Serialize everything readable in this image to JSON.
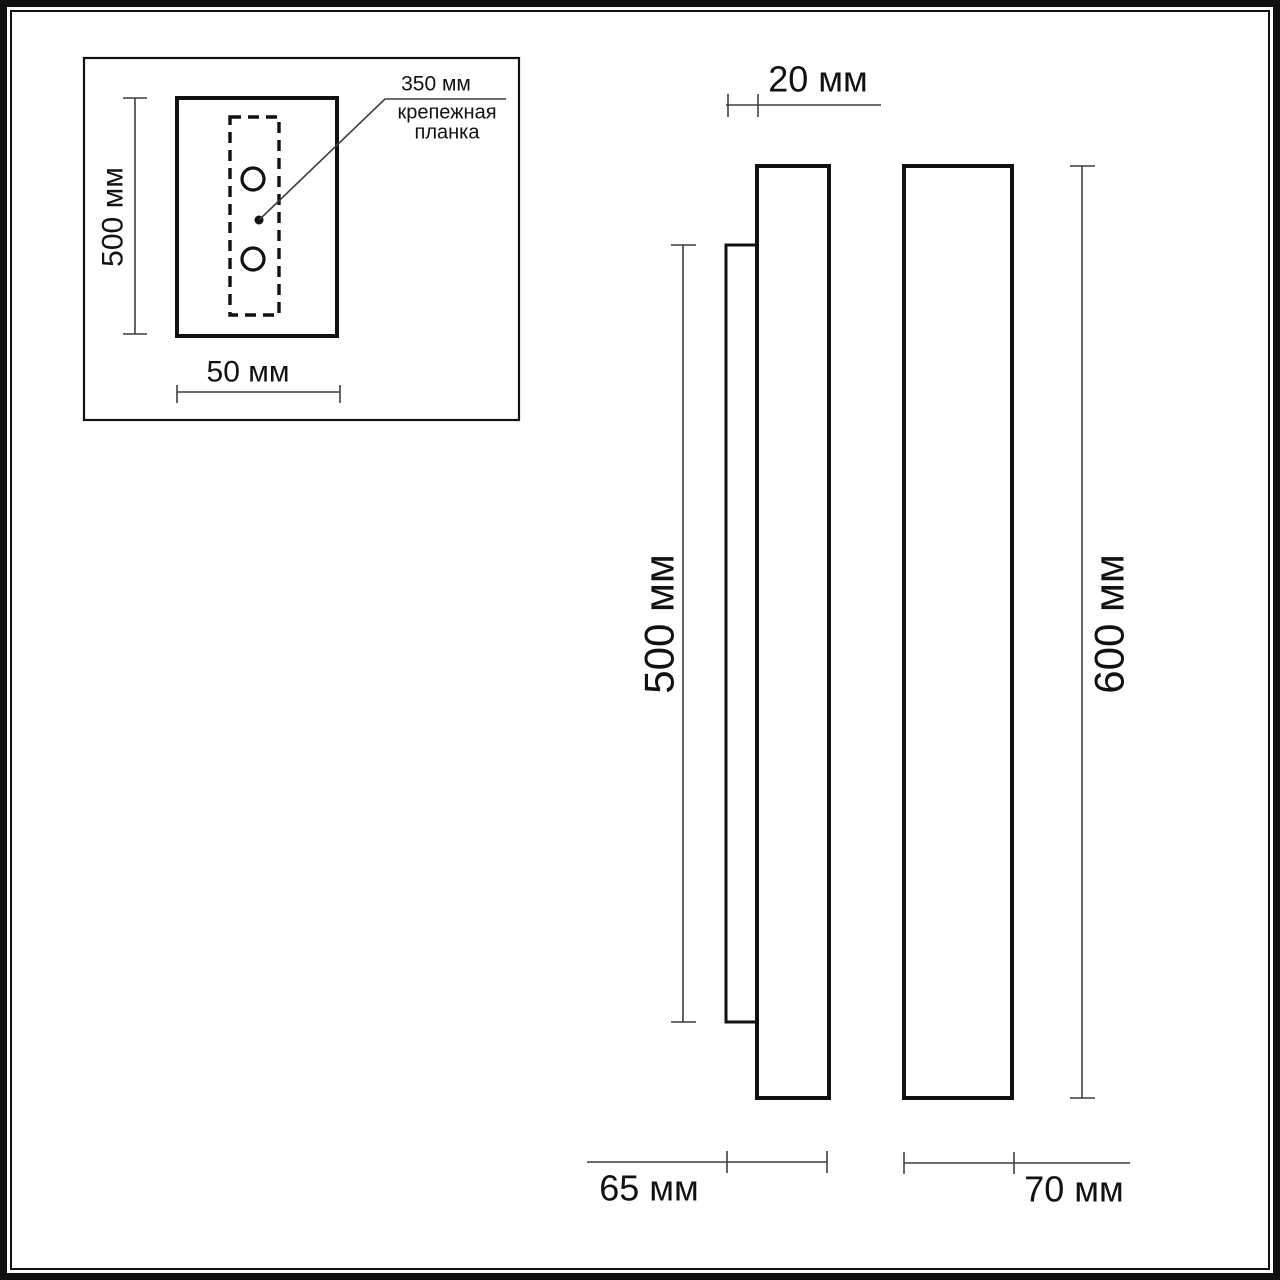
{
  "page": {
    "background": "#ffffff",
    "line_color": "#111111",
    "dim_line_color": "#3f3f3f"
  },
  "inset": {
    "height_dim": "500 мм",
    "width_dim": "50 мм",
    "plate_length_dim": "350 мм",
    "plate_caption": "крепежная\nпланка"
  },
  "side_view": {
    "plate_depth_dim": "20 мм",
    "plate_height_dim": "500 мм",
    "overall_depth_dim": "65 мм"
  },
  "front_view": {
    "overall_height_dim": "600 мм",
    "overall_width_dim": "70 мм"
  }
}
